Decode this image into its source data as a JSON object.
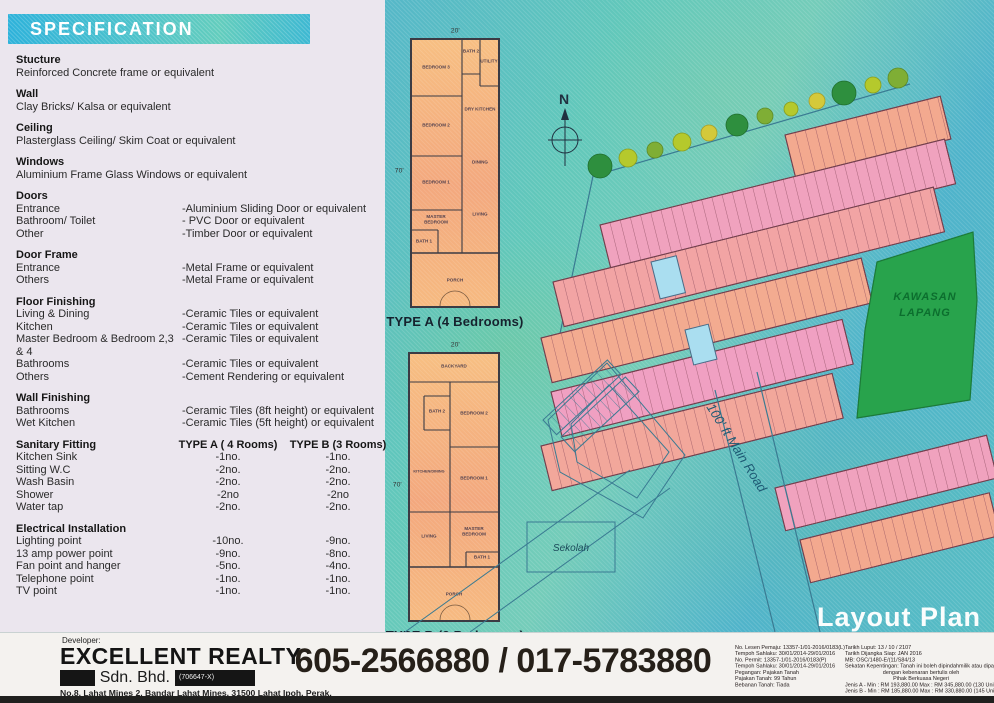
{
  "specification": {
    "title": "SPECIFICATION",
    "simple_sections": [
      {
        "heading": "Stucture",
        "line": "Reinforced Concrete frame or equivalent"
      },
      {
        "heading": "Wall",
        "line": "Clay Bricks/ Kalsa or equivalent"
      },
      {
        "heading": "Ceiling",
        "line": "Plasterglass Ceiling/ Skim Coat or equivalent"
      },
      {
        "heading": "Windows",
        "line": "Aluminium Frame Glass Windows or equivalent"
      }
    ],
    "pair_sections": [
      {
        "heading": "Doors",
        "rows": [
          {
            "label": "Entrance",
            "value": "-Aluminium Sliding Door or equivalent"
          },
          {
            "label": "Bathroom/ Toilet",
            "value": "- PVC Door or equivalent"
          },
          {
            "label": "Other",
            "value": "-Timber Door or equivalent"
          }
        ]
      },
      {
        "heading": "Door Frame",
        "rows": [
          {
            "label": "Entrance",
            "value": "-Metal Frame or equivalent"
          },
          {
            "label": "Others",
            "value": "-Metal Frame or equivalent"
          }
        ]
      },
      {
        "heading": "Floor Finishing",
        "rows": [
          {
            "label": "Living & Dining",
            "value": "-Ceramic Tiles or equivalent"
          },
          {
            "label": "Kitchen",
            "value": "-Ceramic Tiles or equivalent"
          },
          {
            "label": "Master Bedroom & Bedroom 2,3 & 4",
            "value": "-Ceramic Tiles or equivalent"
          },
          {
            "label": "Bathrooms",
            "value": "-Ceramic Tiles or equivalent"
          },
          {
            "label": "Others",
            "value": "-Cement Rendering or equivalent"
          }
        ]
      },
      {
        "heading": "Wall Finishing",
        "rows": [
          {
            "label": "Bathrooms",
            "value": "-Ceramic Tiles (8ft height) or equivalent"
          },
          {
            "label": "Wet Kitchen",
            "value": "-Ceramic Tiles (5ft height) or equivalent"
          }
        ]
      }
    ],
    "sanitary": {
      "heading": "Sanitary Fitting",
      "col_a": "TYPE A ( 4 Rooms)",
      "col_b": "TYPE B (3 Rooms)",
      "rows": [
        {
          "label": "Kitchen Sink",
          "a": "-1no.",
          "b": "-1no."
        },
        {
          "label": "Sitting W.C",
          "a": "-2no.",
          "b": "-2no."
        },
        {
          "label": "Wash Basin",
          "a": "-2no.",
          "b": "-2no."
        },
        {
          "label": "Shower",
          "a": "-2no",
          "b": "-2no"
        },
        {
          "label": "Water tap",
          "a": "-2no.",
          "b": "-2no."
        }
      ]
    },
    "electrical": {
      "heading": "Electrical Installation",
      "rows": [
        {
          "label": "Lighting point",
          "a": "-10no.",
          "b": "-9no."
        },
        {
          "label": "13 amp power point",
          "a": "-9no.",
          "b": "-8no."
        },
        {
          "label": "Fan point and hanger",
          "a": "-5no.",
          "b": "-4no."
        },
        {
          "label": "Telephone point",
          "a": "-1no.",
          "b": "-1no."
        },
        {
          "label": "TV point",
          "a": "-1no.",
          "b": "-1no."
        }
      ]
    }
  },
  "plans": {
    "type_a": {
      "caption": "TYPE A (4 Bedrooms)",
      "width_dim": "20'",
      "depth_dim": "70'",
      "rooms": [
        "BEDROOM 3",
        "BATH 2",
        "UTILITY",
        "BEDROOM 2",
        "DRY KITCHEN",
        "DINING",
        "BEDROOM 1",
        "LIVING",
        "MASTER BEDROOM",
        "BATH 1",
        "PORCH"
      ]
    },
    "type_b": {
      "caption": "TYPE B (3 Bedrooms)",
      "width_dim": "20'",
      "depth_dim": "70'",
      "rooms": [
        "BACKYARD",
        "BATH 2",
        "BEDROOM 2",
        "KITCHEN/DINING",
        "BEDROOM 1",
        "LIVING",
        "MASTER BEDROOM",
        "BATH 1",
        "PORCH"
      ]
    }
  },
  "site_plan": {
    "compass": "N",
    "open_area_line1": "KAWASAN",
    "open_area_line2": "LAPANG",
    "road_label": "100' ft Main Road",
    "school_label": "Sekolah",
    "title": "Layout Plan",
    "colors": {
      "lot_pink": "#f0a2be",
      "lot_salmon": "#f3a98f",
      "open_green": "#28a34c",
      "teal": "#57bdc3"
    }
  },
  "footer": {
    "developer_label": "Developer:",
    "company": "EXCELLENT REALTY",
    "company_suffix": "Sdn. Bhd.",
    "registration": "(706647-X)",
    "address": "No.8, Lahat Mines 2, Bandar Lahat Mines, 31500 Lahat Ipoh, Perak.",
    "phone": "605-2566880 / 017-5783880",
    "legal_left": [
      "No. Lesen Pemaju: 13357-1/01-2016/0183(L)",
      "Tempoh Sahlaku: 30/01/2014-29/01/2016",
      "No. Permit: 13357-1/01-2016/0183(P)",
      "Tempoh Sahlaku: 30/01/2014-29/01/2016",
      "Pegangan: Pajakan Tanah",
      "Pajakan Tanah: 99 Tahun",
      "Bebanan Tanah: Tiada"
    ],
    "legal_right": [
      "Tarikh Luput: 13 / 10 / 2107",
      "Tarikh Dijangka Siap: JAN 2016",
      "MB: OSC/1480-E/(11/S84/13",
      "Sekatan Kepentingan: Tanah ini boleh dipindahmilik atau dipajak",
      "dengan kebenaran bertulis oleh",
      "Pihak Berkuasa Negeri",
      "Jenis A - Min : RM 193,880.00   Max : RM 345,880.00   (130 Unit)",
      "Jenis B - Min : RM 185,880.00   Max : RM 330,880.00   (145 Unit)"
    ]
  }
}
